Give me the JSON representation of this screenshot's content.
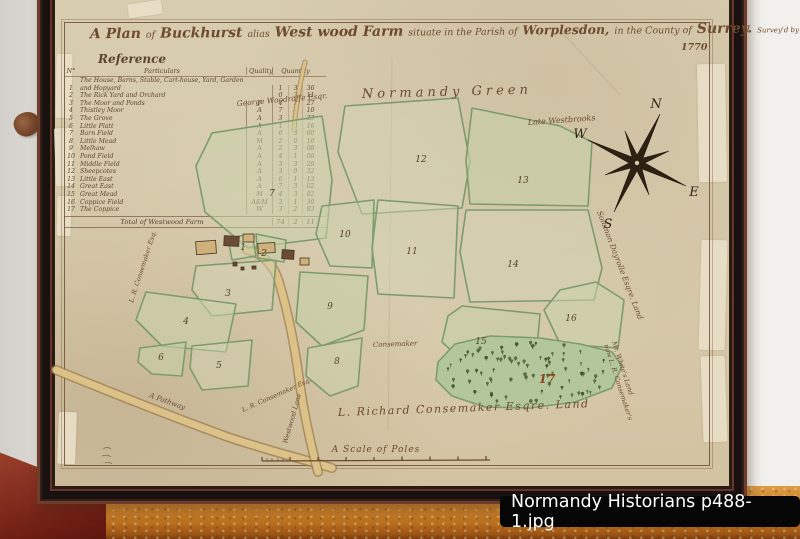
{
  "photo": {
    "caption": "Normandy Historians p488-1.jpg"
  },
  "map": {
    "title": [
      "A Plan",
      "of",
      "Buckhurst",
      "alias",
      "West wood Farm",
      "situate in the Parish of",
      "Worplesdon,",
      "in the County of",
      "Surrey.",
      "Survey'd by John Willock"
    ],
    "date": "1770",
    "compass": {
      "n": "N",
      "e": "E",
      "s": "S",
      "w": "W"
    },
    "scale_label": "A Scale of Poles",
    "labels": {
      "normandy_green": "Normandy Green",
      "late_westbrooks": "Late Westbrooks",
      "george_woodroffe": "George Woodroffe Esqr.",
      "solomon_dayrolle": "Solomon Dayrolle Esqre. Land",
      "mr_whites_line1": "Mr. White's Land",
      "mr_whites_line2": "now L. R. Consemaker's",
      "richard_consemaker": "L. Richard Consemaker Esqre. Land",
      "consemaker": "Consemaker",
      "lr_consemaker_west": "L. R. Consemaker Esq.",
      "lr_consemaker_south": "L. R. Consemaker Esq.",
      "pathway": "A Pathway",
      "westwood_lane": "Westwood Lane"
    },
    "field_labels": [
      "1",
      "2",
      "3",
      "4",
      "5",
      "6",
      "7",
      "8",
      "9",
      "10",
      "11",
      "12",
      "13",
      "14",
      "15",
      "16",
      "17"
    ]
  },
  "reference": {
    "title": "Reference",
    "headers": {
      "no": "N°",
      "particulars": "Particulars",
      "quality": "Quality",
      "quantity": "Quantity"
    },
    "rows": [
      {
        "no": "1",
        "particulars": "The House, Barns, Stable, Cart-house, Yard, Garden and Hopyard",
        "quality": "",
        "a": "1",
        "r": "3",
        "p": "36"
      },
      {
        "no": "2",
        "particulars": "The Rick Yard and Orchard",
        "quality": "",
        "a": "0",
        "r": "3",
        "p": "11"
      },
      {
        "no": "3",
        "particulars": "The Moor and Ponds",
        "quality": "P",
        "a": "4",
        "r": "1",
        "p": "27"
      },
      {
        "no": "4",
        "particulars": "Thistley Moor",
        "quality": "A",
        "a": "7",
        "r": "3",
        "p": "10"
      },
      {
        "no": "5",
        "particulars": "The Grove",
        "quality": "A",
        "a": "3",
        "r": "1",
        "p": "23"
      },
      {
        "no": "6",
        "particulars": "Little Platt",
        "quality": "A",
        "a": "1",
        "r": "0",
        "p": "16"
      },
      {
        "no": "7",
        "particulars": "Barn Field",
        "quality": "A",
        "a": "6",
        "r": "3",
        "p": "00"
      },
      {
        "no": "8",
        "particulars": "Little Mead",
        "quality": "M",
        "a": "2",
        "r": "0",
        "p": "16"
      },
      {
        "no": "9",
        "particulars": "Melhaw",
        "quality": "A",
        "a": "2",
        "r": "3",
        "p": "08"
      },
      {
        "no": "10",
        "particulars": "Pond Field",
        "quality": "A",
        "a": "4",
        "r": "1",
        "p": "00"
      },
      {
        "no": "11",
        "particulars": "Middle Field",
        "quality": "A",
        "a": "3",
        "r": "3",
        "p": "20"
      },
      {
        "no": "12",
        "particulars": "Sheepcotes",
        "quality": "A",
        "a": "3",
        "r": "0",
        "p": "32"
      },
      {
        "no": "13",
        "particulars": "Little East",
        "quality": "A",
        "a": "6",
        "r": "1",
        "p": "13"
      },
      {
        "no": "14",
        "particulars": "Great East",
        "quality": "A",
        "a": "7",
        "r": "3",
        "p": "02"
      },
      {
        "no": "15",
        "particulars": "Great Mead",
        "quality": "M",
        "a": "4",
        "r": "3",
        "p": "02"
      },
      {
        "no": "16",
        "particulars": "Coppice Field",
        "quality": "A&M",
        "a": "3",
        "r": "1",
        "p": "30"
      },
      {
        "no": "17",
        "particulars": "The Coppice",
        "quality": "W",
        "a": "3",
        "r": "2",
        "p": "03"
      }
    ],
    "total": {
      "label": "Total of Westwood Farm",
      "a": "74",
      "r": "2",
      "p": "11"
    }
  }
}
